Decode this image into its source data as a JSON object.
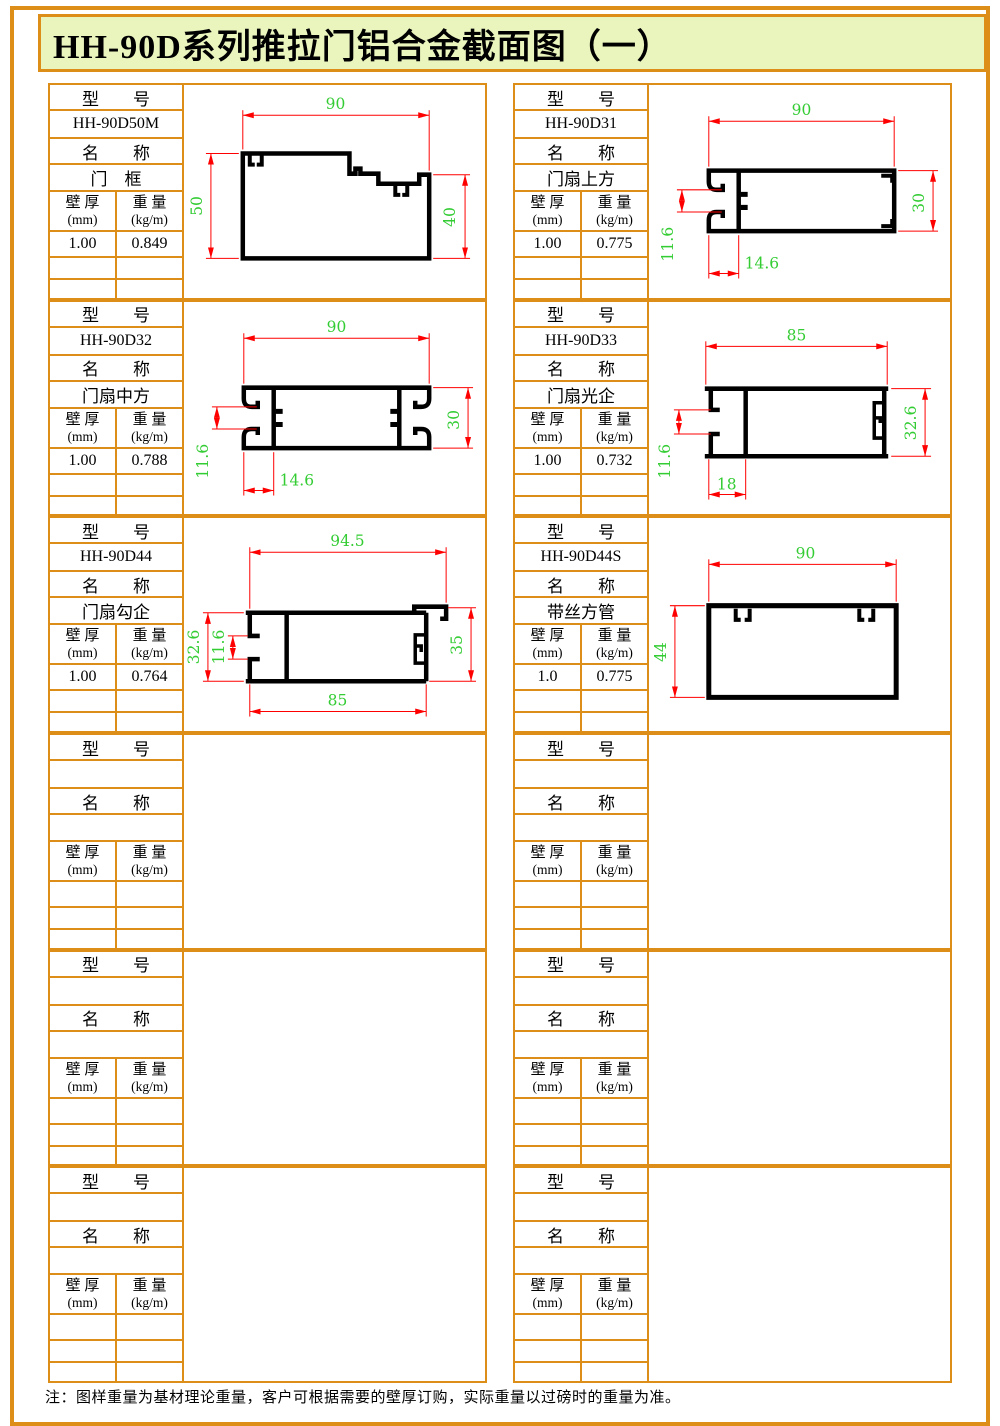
{
  "title": "HH-90D系列推拉门铝合金截面图（一）",
  "note": "注：图样重量为基材理论重量，客户可根据需要的壁厚订购，实际重量以过磅时的重量为准。",
  "labels": {
    "model": "型　　号",
    "name": "名　　称",
    "wall1": "壁 厚",
    "wall2": "(mm)",
    "weight1": "重 量",
    "weight2": "(kg/m)"
  },
  "colors": {
    "border_orange": "#DC8E18",
    "title_background": "#EAF5BE",
    "dimension_line_red": "#FF0000",
    "dimension_text_green": "#33CC33",
    "profile_black": "#000000"
  },
  "cards": [
    {
      "model": "HH-90D50M",
      "name": "门　框",
      "thickness": "1.00",
      "weight": "0.849",
      "dims": {
        "width": "90",
        "left": "50",
        "right": "40"
      }
    },
    {
      "model": "HH-90D31",
      "name": "门扇上方",
      "thickness": "1.00",
      "weight": "0.775",
      "dims": {
        "width": "90",
        "side": "30",
        "gap": "11.6",
        "inset": "14.6"
      }
    },
    {
      "model": "HH-90D32",
      "name": "门扇中方",
      "thickness": "1.00",
      "weight": "0.788",
      "dims": {
        "width": "90",
        "side": "30",
        "gap": "11.6",
        "inset": "14.6"
      }
    },
    {
      "model": "HH-90D33",
      "name": "门扇光企",
      "thickness": "1.00",
      "weight": "0.732",
      "dims": {
        "width": "85",
        "side": "32.6",
        "gap": "11.6",
        "inset": "18"
      }
    },
    {
      "model": "HH-90D44",
      "name": "门扇勾企",
      "thickness": "1.00",
      "weight": "0.764",
      "dims": {
        "width": "94.5",
        "left": "32.6",
        "gap": "11.6",
        "right": "35",
        "bottom": "85"
      }
    },
    {
      "model": "HH-90D44S",
      "name": "带丝方管",
      "thickness": "1.0",
      "weight": "0.775",
      "dims": {
        "width": "90",
        "side": "44"
      }
    },
    {
      "model": "",
      "name": "",
      "thickness": "",
      "weight": ""
    },
    {
      "model": "",
      "name": "",
      "thickness": "",
      "weight": ""
    },
    {
      "model": "",
      "name": "",
      "thickness": "",
      "weight": ""
    },
    {
      "model": "",
      "name": "",
      "thickness": "",
      "weight": ""
    },
    {
      "model": "",
      "name": "",
      "thickness": "",
      "weight": ""
    },
    {
      "model": "",
      "name": "",
      "thickness": "",
      "weight": ""
    }
  ]
}
